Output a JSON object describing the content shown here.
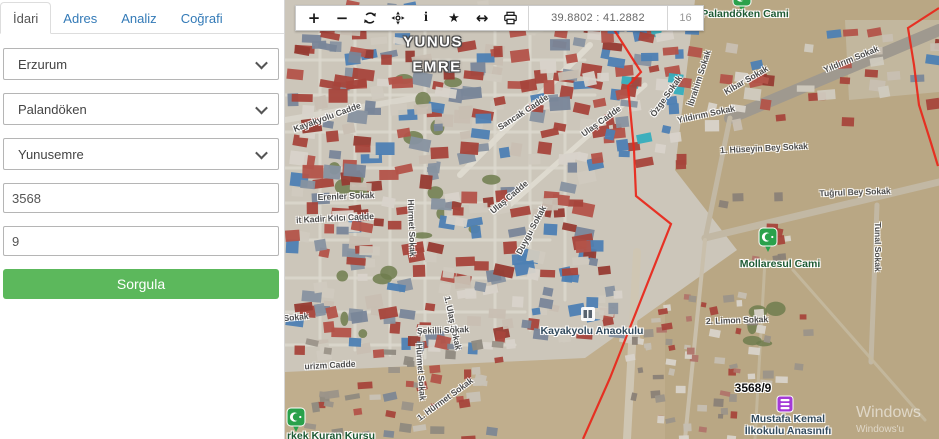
{
  "sidebar": {
    "tabs": [
      {
        "label": "İdari",
        "active": true
      },
      {
        "label": "Adres",
        "active": false
      },
      {
        "label": "Analiz",
        "active": false
      },
      {
        "label": "Coğrafi",
        "active": false
      }
    ],
    "province": {
      "value": "Erzurum"
    },
    "district": {
      "value": "Palandöken"
    },
    "neighborhood": {
      "value": "Yunusemre"
    },
    "ada": {
      "value": "3568"
    },
    "parsel": {
      "value": "9"
    },
    "query_button": "Sorgula",
    "accent_color": "#5cb85c",
    "link_color": "#337ab7"
  },
  "toolbar": {
    "icons": [
      "zoom-in",
      "zoom-out",
      "refresh",
      "locate",
      "info",
      "favorite",
      "measure",
      "print"
    ],
    "coordinates": "39.8802 : 41.2882",
    "zoom_level": "16"
  },
  "map": {
    "boundary_color": "#e8291c",
    "labels": [
      {
        "text": "YUNUS",
        "x": 148,
        "y": 42,
        "rot": 0,
        "cls": "region"
      },
      {
        "text": "EMRE",
        "x": 152,
        "y": 67,
        "rot": 0,
        "cls": "region"
      },
      {
        "text": "Palandöken Cami",
        "x": 460,
        "y": 14,
        "rot": 0,
        "cls": "poi-green"
      },
      {
        "text": "Yıldırım Sokak",
        "x": 566,
        "y": 59,
        "rot": -22,
        "cls": "street"
      },
      {
        "text": "Kibar Sokak",
        "x": 461,
        "y": 80,
        "rot": -30,
        "cls": "street"
      },
      {
        "text": "İbrahim Sokak",
        "x": 414,
        "y": 78,
        "rot": -72,
        "cls": "street"
      },
      {
        "text": "Özge Sokak",
        "x": 381,
        "y": 96,
        "rot": -55,
        "cls": "street"
      },
      {
        "text": "Yıldırım Sokak",
        "x": 421,
        "y": 114,
        "rot": -12,
        "cls": "street"
      },
      {
        "text": "Sancak Cadde",
        "x": 238,
        "y": 112,
        "rot": -33,
        "cls": "street"
      },
      {
        "text": "Ulaş Cadde",
        "x": 316,
        "y": 121,
        "rot": -36,
        "cls": "street"
      },
      {
        "text": "Kayakyolu Cadde",
        "x": 42,
        "y": 117,
        "rot": -20,
        "cls": "street"
      },
      {
        "text": "1. Hüseyin Bey Sokak",
        "x": 479,
        "y": 148,
        "rot": -3,
        "cls": "street"
      },
      {
        "text": "Tuğrul Bey Sokak",
        "x": 570,
        "y": 192,
        "rot": -2,
        "cls": "street"
      },
      {
        "text": "Tunal Sokak",
        "x": 593,
        "y": 247,
        "rot": 90,
        "cls": "street"
      },
      {
        "text": "Erenler Sokak",
        "x": 61,
        "y": 196,
        "rot": -2,
        "cls": "street"
      },
      {
        "text": "it Kadir Kılcı Cadde",
        "x": 50,
        "y": 218,
        "rot": -3,
        "cls": "street"
      },
      {
        "text": "Hürmet Sokak",
        "x": 127,
        "y": 228,
        "rot": 88,
        "cls": "street"
      },
      {
        "text": "Ulaş Cadde",
        "x": 224,
        "y": 197,
        "rot": -40,
        "cls": "street"
      },
      {
        "text": "Duygu Sokak",
        "x": 246,
        "y": 230,
        "rot": -62,
        "cls": "street"
      },
      {
        "text": "1. Ulaş Sokak",
        "x": 168,
        "y": 323,
        "rot": 78,
        "cls": "street"
      },
      {
        "text": "Sokak",
        "x": 11,
        "y": 317,
        "rot": -5,
        "cls": "street"
      },
      {
        "text": "Şekilli Sokak",
        "x": 158,
        "y": 330,
        "rot": -2,
        "cls": "street"
      },
      {
        "text": "urizm Cadde",
        "x": 45,
        "y": 365,
        "rot": -3,
        "cls": "street"
      },
      {
        "text": "Hürmet Sokak",
        "x": 136,
        "y": 372,
        "rot": 86,
        "cls": "street"
      },
      {
        "text": "1. Hürmet Sokak",
        "x": 160,
        "y": 399,
        "rot": -36,
        "cls": "street"
      },
      {
        "text": "2. Limon Sokak",
        "x": 452,
        "y": 320,
        "rot": -2,
        "cls": "street"
      },
      {
        "text": "Kayakyolu Anaokulu",
        "x": 307,
        "y": 331,
        "rot": 0,
        "cls": "poi-blue"
      },
      {
        "text": "Mollaresul Cami",
        "x": 495,
        "y": 264,
        "rot": 0,
        "cls": "poi-green"
      },
      {
        "text": "3568/9",
        "x": 468,
        "y": 388,
        "rot": 0,
        "cls": "parcel"
      },
      {
        "text": "Mustafa Kemal",
        "x": 503,
        "y": 419,
        "rot": 0,
        "cls": "poi-blue"
      },
      {
        "text": "İlkokulu Anasınıfı",
        "x": 503,
        "y": 431,
        "rot": 0,
        "cls": "poi-blue"
      },
      {
        "text": "rkek Kuran Kursu",
        "x": 46,
        "y": 436,
        "rot": 0,
        "cls": "poi-green"
      }
    ],
    "markers": [
      {
        "type": "mosque-pin",
        "x": 457,
        "y": 12
      },
      {
        "type": "mosque-pin",
        "x": 483,
        "y": 252
      },
      {
        "type": "mosque-pin",
        "x": 11,
        "y": 432
      },
      {
        "type": "school-marker",
        "x": 500,
        "y": 404
      },
      {
        "type": "building-icon",
        "x": 303,
        "y": 314
      }
    ],
    "boundaries": [
      {
        "points": [
          [
            328,
            28
          ],
          [
            356,
            72
          ],
          [
            343,
            86
          ],
          [
            349,
            150
          ],
          [
            351,
            196
          ],
          [
            386,
            224
          ],
          [
            363,
            282
          ],
          [
            325,
            378
          ],
          [
            298,
            439
          ]
        ]
      },
      {
        "points": [
          [
            654,
            8
          ],
          [
            623,
            28
          ],
          [
            629,
            65
          ],
          [
            634,
            105
          ],
          [
            646,
            143
          ],
          [
            653,
            166
          ]
        ]
      }
    ],
    "watermark": {
      "line1": "Windows",
      "line2": "Windows'u"
    }
  }
}
